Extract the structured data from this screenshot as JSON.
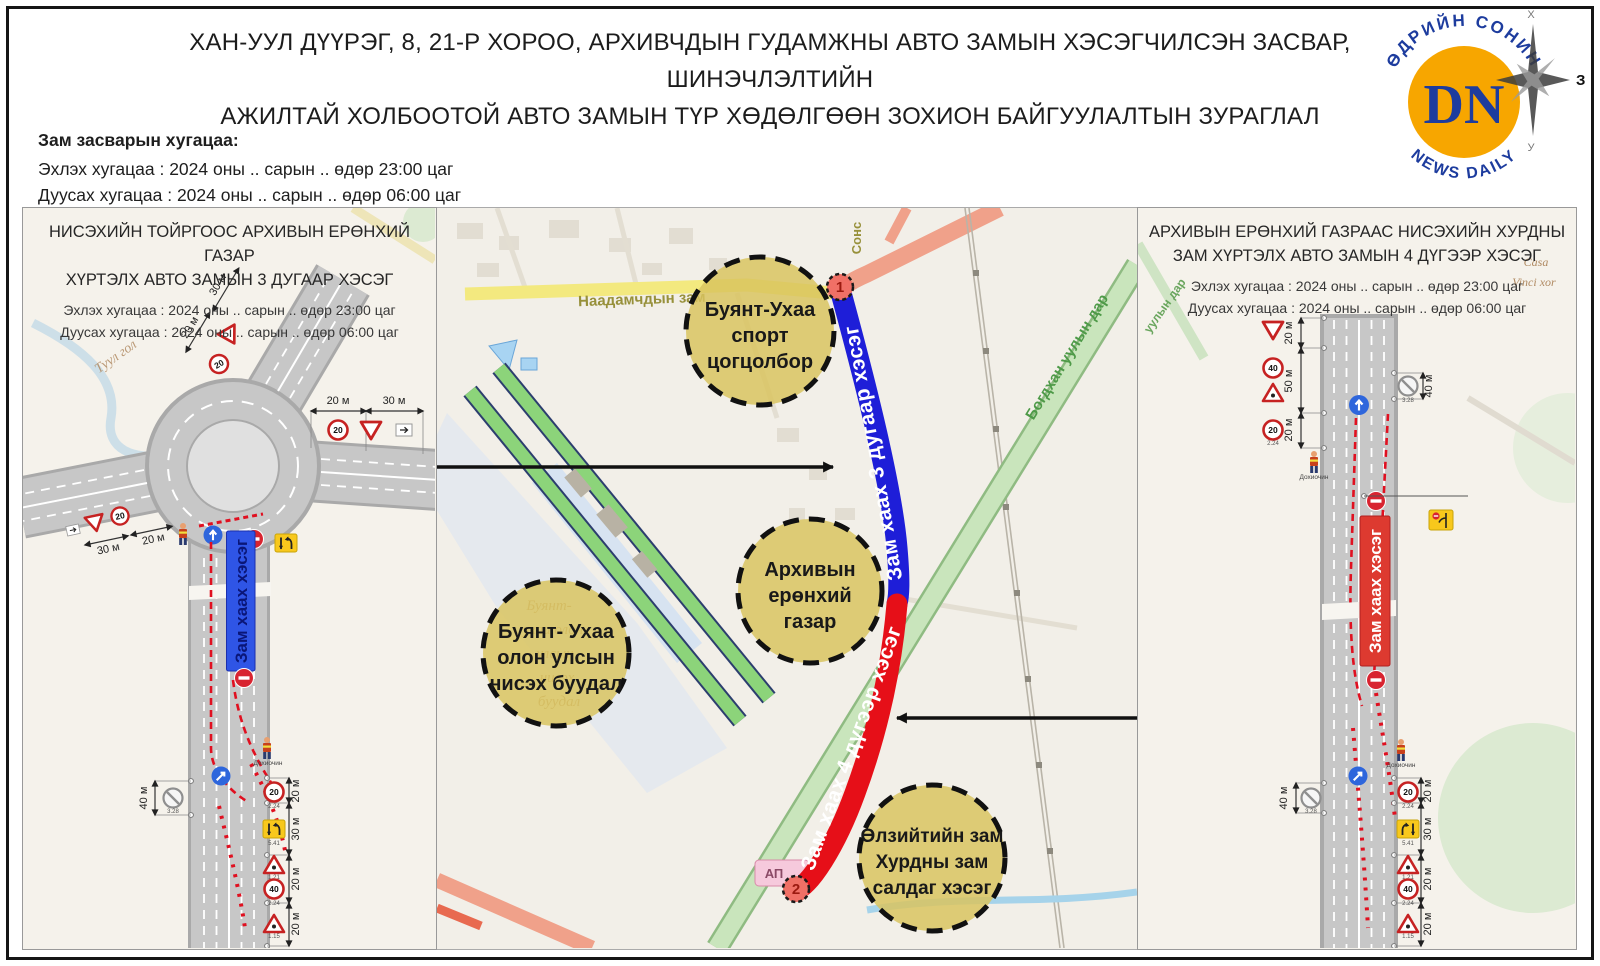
{
  "page": {
    "title1": "ХАН-УУЛ ДҮҮРЭГ, 8, 21-Р ХОРОО, АРХИВЧДЫН ГУДАМЖНЫ АВТО ЗАМЫН ХЭСЭГЧИЛСЭН ЗАСВАР, ШИНЭЧЛЭЛТИЙН",
    "title2": "АЖИЛТАЙ ХОЛБООТОЙ АВТО ЗАМЫН ТҮР ХӨДӨЛГӨӨН ЗОХИОН БАЙГУУЛАЛТЫН ЗУРАГЛАЛ"
  },
  "logo": {
    "monogram": "DN",
    "ring_top": "ӨДРИЙН СОНИН",
    "ring_bottom": "NEWS        DAILY",
    "compass_north": "Х",
    "compass_south": "У",
    "compass_east": "З",
    "circle_color": "#F7A600",
    "text_color": "#1D3C9E"
  },
  "repair": {
    "heading": "Зам засварын хугацаа:",
    "start": "Эхлэх хугацаа : 2024 оны .. сарын .. өдөр 23:00 цаг",
    "end": "Дуусах хугацаа : 2024 оны .. сарын .. өдөр 06:00 цаг"
  },
  "signs": {
    "speed20": "20",
    "speed40": "40",
    "code_speed": "2.24",
    "code_lane": "5.41",
    "code_worker": "1.21",
    "code_narrow": "1.15",
    "code_nostop": "3.28",
    "flagman": "Дохиочин"
  },
  "left_panel": {
    "title1": "НИСЭХИЙН ТОЙРГООС АРХИВЫН ЕРӨНХИЙ ГАЗАР",
    "title2": "ХҮРТЭЛХ АВТО ЗАМЫН 3 ДУГААР ХЭСЭГ",
    "start": "Эхлэх хугацаа : 2024 оны .. сарын .. өдөр 23:00 цаг",
    "end": "Дуусах хугацаа : 2024 оны .. сарын .. өдөр 06:00 цаг",
    "closure": "Зам хаах хэсэг",
    "river": "Туул гол",
    "meas": {
      "ne_outer": "30 м",
      "ne_inner": "20 м",
      "east_inner": "20 м",
      "east_outer": "30 м",
      "sw_inner": "20 м",
      "sw_outer": "30 м",
      "left": "40 м",
      "b1": "20 м",
      "b2": "30 м",
      "b3": "20 м",
      "b4": "20 м"
    }
  },
  "right_panel": {
    "title1": "АРХИВЫН ЕРӨНХИЙ ГАЗРААС НИСЭХИЙН ХУРДНЫ",
    "title2": "ЗАМ ХҮРТЭЛХ АВТО ЗАМЫН 4 ДҮГЭЭР ХЭСЭГ",
    "start": "Эхлэх хугацаа : 2024 оны .. сарын .. өдөр 23:00 цаг",
    "end": "Дуусах хугацаа : 2024 оны .. сарын .. өдөр 06:00 цаг",
    "closure": "Зам хаах хэсэг",
    "bg_casa": "Casa",
    "bg_vinci": "Vinci xor",
    "bg_bogd": "уулын дар",
    "meas": {
      "l1": "20 м",
      "l2": "50 м",
      "l3": "20 м",
      "right": "40 м",
      "left_bottom": "40 м",
      "b1": "20 м",
      "b2": "30 м",
      "b3": "20 м",
      "b4": "20 м"
    }
  },
  "map": {
    "closure3": "Зам хаах 3 дугаар хэсэг",
    "closure4": "Зам хаах 4 дүгээр хэсэг",
    "markers": {
      "m1": "1",
      "m2": "2"
    },
    "roads": {
      "naadam": "Наадамчдын зам",
      "bogd": "Богдхан уулын дар",
      "sons": "Сонс"
    },
    "airport_label": {
      "l1": "Буянт-",
      "l2": "ухаа олон",
      "l3": "улсын",
      "l4": "нисэх",
      "l5": "буудал"
    },
    "poi_sport": {
      "l1": "Буянт-Ухаа",
      "l2": "спорт",
      "l3": "цогцолбор"
    },
    "poi_archive": {
      "l1": "Архивын",
      "l2": "ерөнхий",
      "l3": "газар"
    },
    "poi_airport": {
      "l1": "Буянт- Ухаа",
      "l2": "олон улсын",
      "l3": "нисэх буудал"
    },
    "poi_junction": {
      "l1": "Өлзийтийн зам",
      "l2": "Хурдны зам",
      "l3": "салдаг хэсэг"
    },
    "small_label": "АП",
    "colors": {
      "closed_blue": "#1E1ED8",
      "closed_red": "#E60F18",
      "poi_fill": "#D9C45E",
      "marker_fill": "#F07066"
    }
  }
}
